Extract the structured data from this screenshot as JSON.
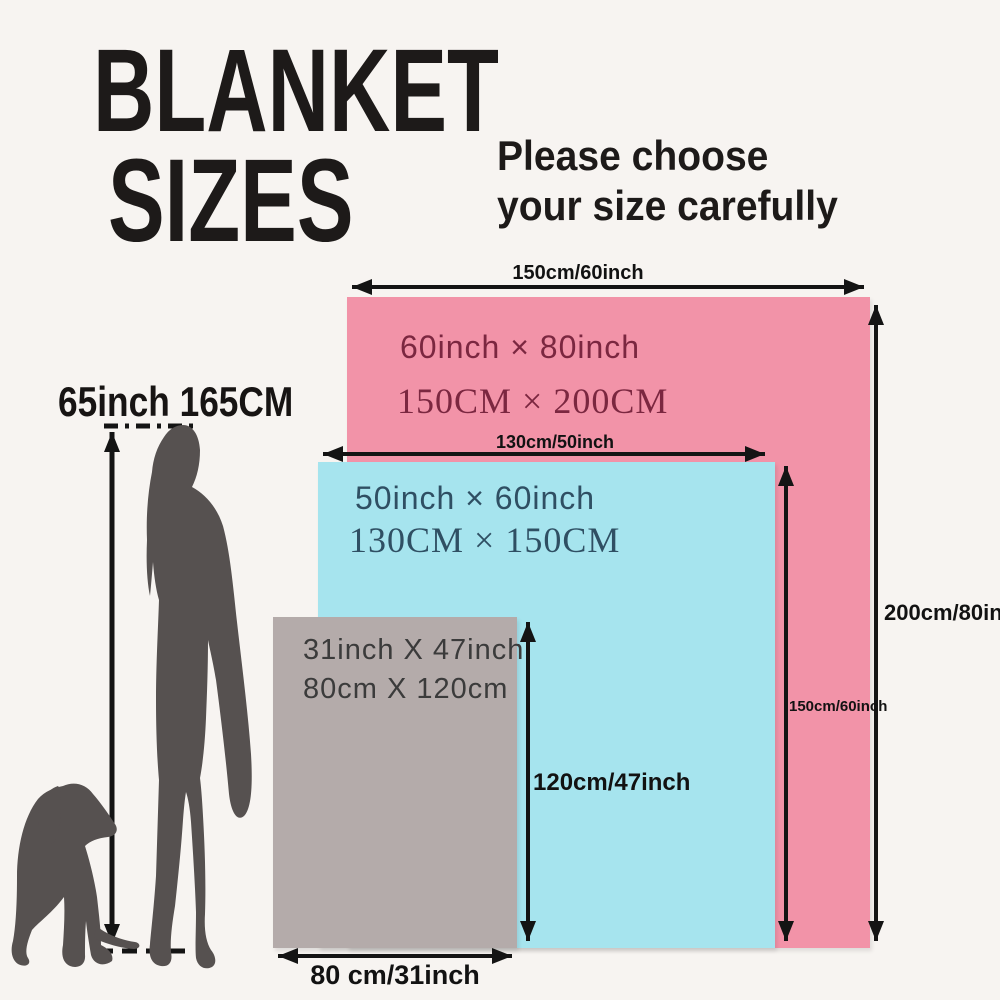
{
  "title": {
    "line1": "BLANKET",
    "line2": "SIZES"
  },
  "subtitle": {
    "line1": "Please choose",
    "line2": "your size carefully"
  },
  "person": {
    "height_label": "65inch 165CM"
  },
  "colors": {
    "background": "#f7f4f1",
    "ink": "#1d1a19",
    "silhouette": "#565150",
    "blanket_large_fill": "#f293a8",
    "blanket_medium_fill": "#a6e4ee",
    "blanket_small_fill": "#b4abaa",
    "blanket_large_text": "#7b2740",
    "blanket_medium_text": "#2f4f63",
    "blanket_small_text": "#3b3b3b"
  },
  "blankets": {
    "large": {
      "inch_label": "60inch × 80inch",
      "cm_label": "150CM × 200CM",
      "width_label": "150cm/60inch",
      "height_label": "200cm/80inch"
    },
    "medium": {
      "inch_label": "50inch × 60inch",
      "cm_label": "130CM × 150CM",
      "width_label": "130cm/50inch",
      "height_label": "150cm/60inch"
    },
    "small": {
      "inch_label": "31inch X 47inch",
      "cm_label": "80cm X 120cm",
      "width_label": "80 cm/31inch",
      "height_label": "120cm/47inch"
    }
  }
}
